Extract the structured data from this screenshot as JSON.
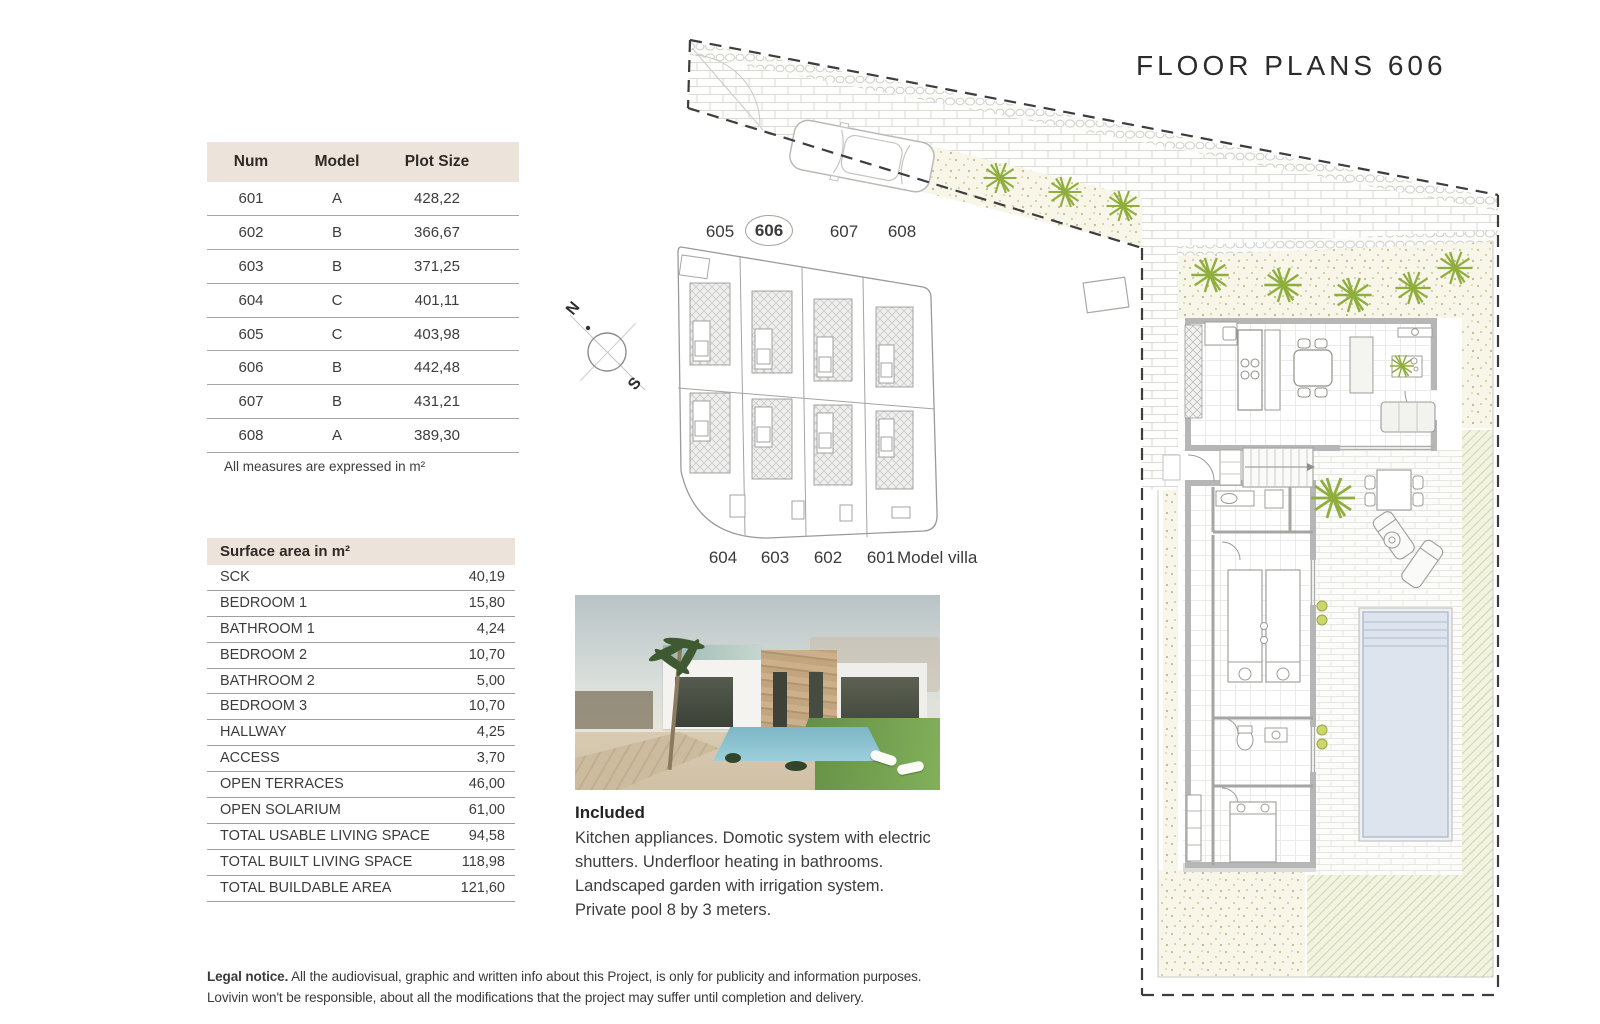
{
  "title": "FLOOR PLANS 606",
  "plots_table": {
    "headers": [
      "Num",
      "Model",
      "Plot Size"
    ],
    "rows": [
      [
        "601",
        "A",
        "428,22"
      ],
      [
        "602",
        "B",
        "366,67"
      ],
      [
        "603",
        "B",
        "371,25"
      ],
      [
        "604",
        "C",
        "401,11"
      ],
      [
        "605",
        "C",
        "403,98"
      ],
      [
        "606",
        "B",
        "442,48"
      ],
      [
        "607",
        "B",
        "431,21"
      ],
      [
        "608",
        "A",
        "389,30"
      ]
    ],
    "note": "All measures are expressed in m²"
  },
  "surface_table": {
    "header": "Surface area in m²",
    "rows": [
      {
        "label": "SCK",
        "value": "40,19"
      },
      {
        "label": "BEDROOM 1",
        "value": "15,80"
      },
      {
        "label": "BATHROOM 1",
        "value": "4,24"
      },
      {
        "label": "BEDROOM 2",
        "value": "10,70"
      },
      {
        "label": "BATHROOM 2",
        "value": "5,00"
      },
      {
        "label": "BEDROOM 3",
        "value": "10,70"
      },
      {
        "label": "HALLWAY",
        "value": "4,25"
      },
      {
        "label": "ACCESS",
        "value": "3,70"
      },
      {
        "label": "OPEN TERRACES",
        "value": "46,00"
      },
      {
        "label": "OPEN SOLARIUM",
        "value": "61,00"
      },
      {
        "label": "TOTAL USABLE LIVING SPACE",
        "value": "94,58"
      },
      {
        "label": "TOTAL BUILT LIVING SPACE",
        "value": "118,98"
      },
      {
        "label": "TOTAL BUILDABLE AREA",
        "value": "121,60"
      }
    ]
  },
  "site_plan": {
    "top_labels": [
      "605",
      "606",
      "607",
      "608"
    ],
    "highlighted_plot": "606",
    "bottom_labels": [
      "604",
      "603",
      "602",
      "601"
    ],
    "bottom_caption": "Model villa",
    "compass": {
      "north": "N",
      "south": "S"
    }
  },
  "included": {
    "heading": "Included",
    "body_lines": "Kitchen appliances. Domotic system with electric\nshutters. Underfloor heating in bathrooms.\nLandscaped garden with irrigation system.\nPrivate pool 8 by 3 meters."
  },
  "legal": {
    "bold": "Legal notice.",
    "line1": " All the audiovisual, graphic and written info about this Project, is only for publicity and information purposes.",
    "line2": "Lovivin won't be responsible, about all the modifications that the project may suffer until completion and delivery."
  },
  "colors": {
    "header_beige": "#ece4db",
    "table_line": "#a8a6a3",
    "text_dark": "#3c3c3c",
    "gravel": "#f7f6e9",
    "gravel_dot": "#c5c189",
    "plant_green": "#8fae3e",
    "pool_water": "#dde4ee",
    "hatch_olive": "#d3d6a8",
    "wall_gray": "#b6b6b6",
    "dash_color": "#3d3d3d"
  }
}
